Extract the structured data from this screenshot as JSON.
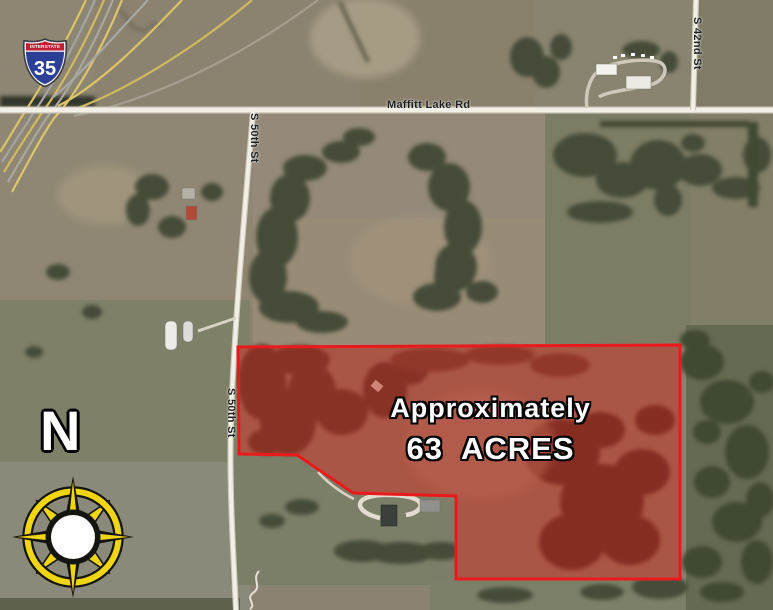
{
  "interstate_shield": {
    "banner": "INTERSTATE",
    "route_number": "35"
  },
  "roads": {
    "maffitt_lake_rd": "Maffitt Lake Rd",
    "s_50th_st_upper": "S 50th St",
    "s_50th_st_lower": "S 50th St",
    "s_42nd_st": "S 42nd St"
  },
  "parcel": {
    "label_line1": "Approximately",
    "label_line2": "63  ACRES",
    "border_color": "#ea1a1c",
    "fill_color": "rgba(195,32,22,0.44)"
  },
  "compass": {
    "north_label": "N",
    "accent_color": "#f0d511"
  }
}
